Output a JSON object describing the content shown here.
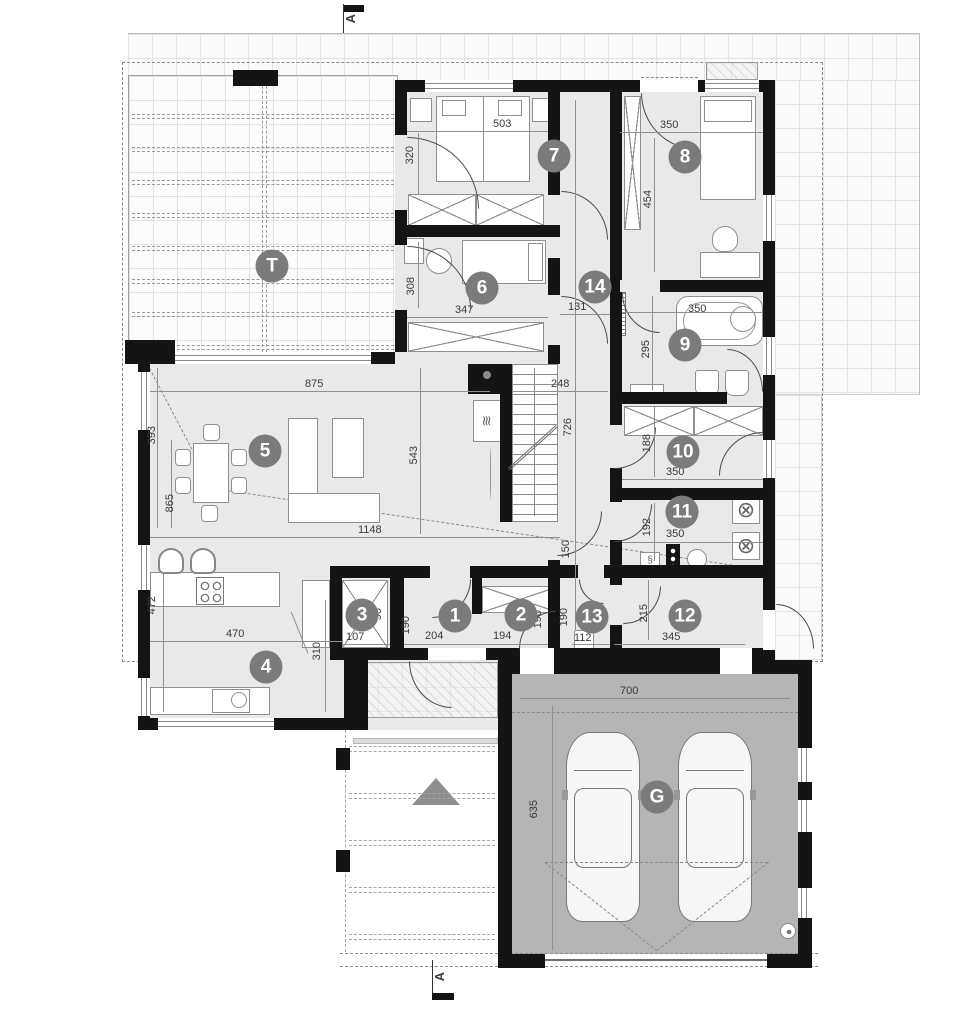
{
  "section": {
    "label": "A"
  },
  "icons": {
    "washer": "⊗",
    "meter": "§",
    "fireplace": "≋"
  },
  "rooms": {
    "r1": {
      "num": "1",
      "dim_w": "204",
      "dim_h": "190"
    },
    "r2": {
      "num": "2",
      "dim_w": "194",
      "dim_h": "190"
    },
    "r3": {
      "num": "3",
      "dim_w": "107",
      "dim_h": "90"
    },
    "r4": {
      "num": "4",
      "dim_w": "470",
      "dim_h": "472",
      "dim_h2": "310"
    },
    "r5": {
      "num": "5",
      "dim_w": "875",
      "dim_w2": "1148",
      "dim_h": "393",
      "dim_h2": "865",
      "dim_h3": "543"
    },
    "r6": {
      "num": "6",
      "dim_w": "347",
      "dim_h": "308"
    },
    "r7": {
      "num": "7",
      "dim_w": "503",
      "dim_h": "320"
    },
    "r8": {
      "num": "8",
      "dim_w": "350",
      "dim_h": "454"
    },
    "r9": {
      "num": "9",
      "dim_w": "350",
      "dim_h": "295"
    },
    "r10": {
      "num": "10",
      "dim_w": "350",
      "dim_h": "188"
    },
    "r11": {
      "num": "11",
      "dim_w": "350",
      "dim_h": "192"
    },
    "r12": {
      "num": "12",
      "dim_w": "345",
      "dim_h": "215"
    },
    "r13": {
      "num": "13",
      "dim_w": "112",
      "dim_h": "190",
      "dim_h2": "150"
    },
    "r14": {
      "num": "14",
      "dim_w": "131",
      "dim_w2": "248",
      "dim_h": "726"
    },
    "terrace": {
      "num": "T"
    },
    "garage": {
      "num": "G",
      "dim_w": "700",
      "dim_h": "635"
    }
  },
  "colors": {
    "wall": "#141414",
    "floor": "#e9e9e9",
    "garage_floor": "#b5b5b5",
    "label_circle": "#7b7b7b"
  }
}
